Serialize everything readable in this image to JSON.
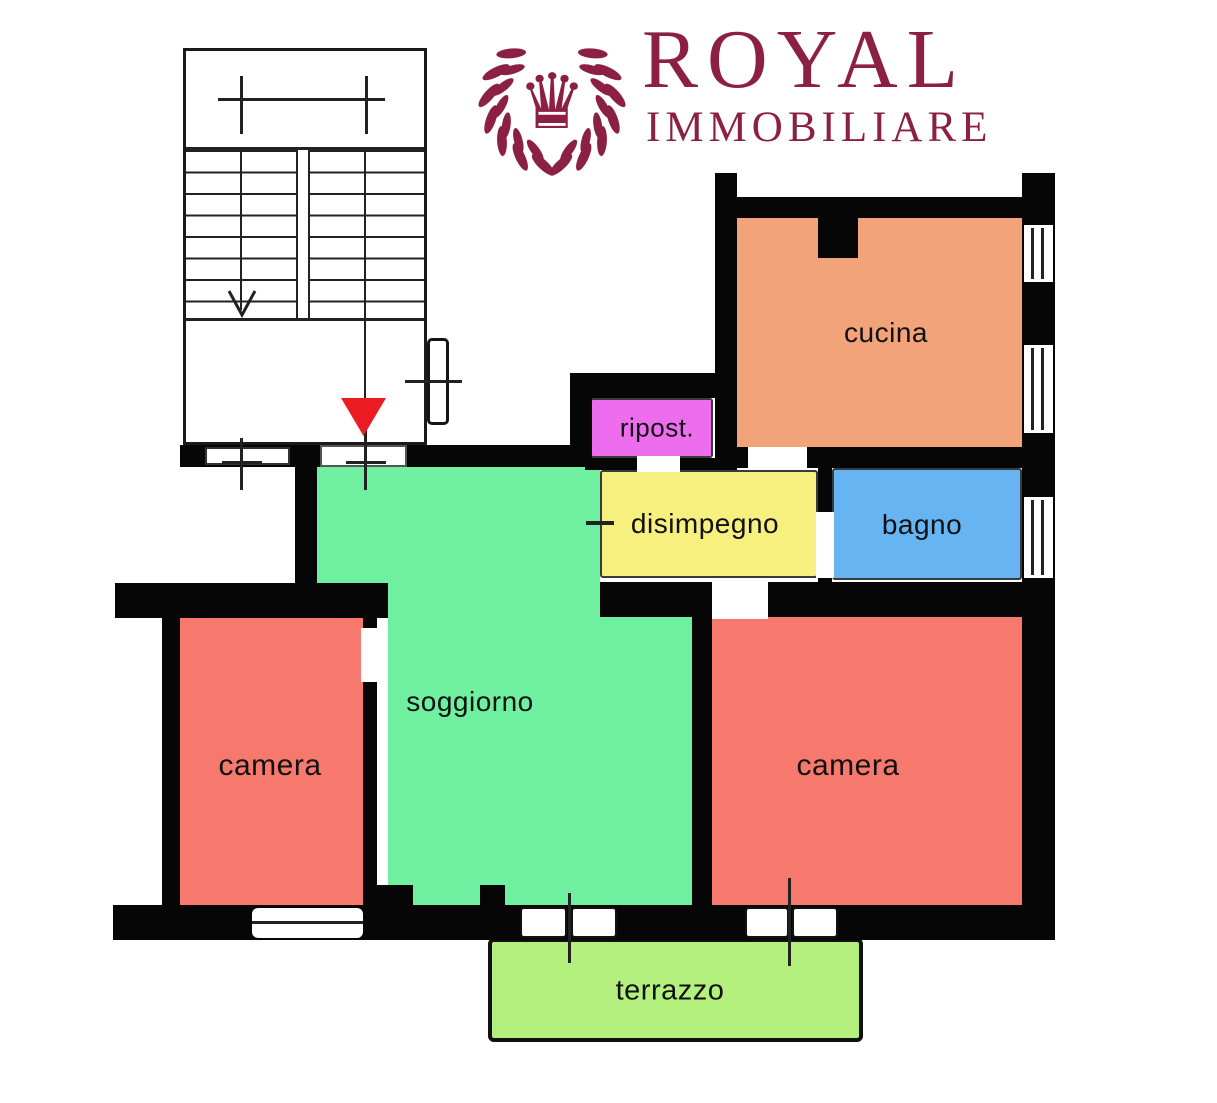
{
  "logo": {
    "title": "ROYAL",
    "subtitle": "IMMOBILIARE",
    "color": "#8C2043",
    "icon": "crown-laurel-wreath"
  },
  "floorplan": {
    "wall_color": "#060606",
    "window_color": "#ffffff",
    "staircase": {
      "arrow_direction": "down"
    },
    "entrance_marker": {
      "shape": "triangle-down",
      "color": "#EC1C24"
    },
    "rooms": [
      {
        "id": "cucina",
        "label": "cucina",
        "color": "#F2A379"
      },
      {
        "id": "ripostiglio",
        "label": "ripost.",
        "color": "#EE6DEE"
      },
      {
        "id": "disimpegno",
        "label": "disimpegno",
        "color": "#F7F07E"
      },
      {
        "id": "bagno",
        "label": "bagno",
        "color": "#66B5F2"
      },
      {
        "id": "soggiorno",
        "label": "soggiorno",
        "color": "#6FF0A1"
      },
      {
        "id": "camera_left",
        "label": "camera",
        "color": "#F7796E"
      },
      {
        "id": "camera_right",
        "label": "camera",
        "color": "#F7796E"
      },
      {
        "id": "terrazzo",
        "label": "terrazzo",
        "color": "#B3F07D"
      }
    ]
  }
}
